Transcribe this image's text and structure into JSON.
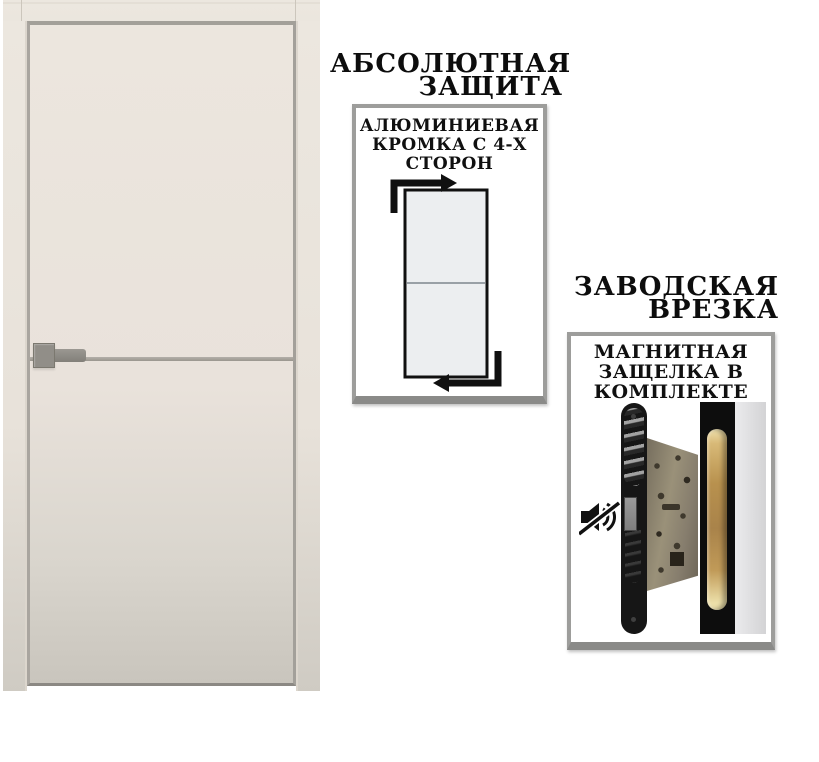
{
  "edge_feature": {
    "title_lines": [
      "АБСОЛЮТНАЯ",
      "ЗАЩИТА"
    ],
    "caption_lines": [
      "АЛЮМИНИЕВАЯ",
      "КРОМКА С 4-Х",
      "СТОРОН"
    ]
  },
  "latch_feature": {
    "title_lines": [
      "ЗАВОДСКАЯ",
      "ВРЕЗКА"
    ],
    "caption_lines": [
      "МАГНИТНАЯ",
      "ЗАЩЕЛКА В",
      "КОМПЛЕКТЕ"
    ]
  },
  "door": {
    "leaf_color_top": "#ece6de",
    "leaf_color_bottom": "#c9c5bd",
    "frame_color": "#ece7df",
    "aluminum_edge_color": "#a3a099",
    "molding_color": "#9a968e",
    "handle_color": "#918e88"
  },
  "panels": {
    "background": "#ffffff",
    "border_color": "#9d9d9b",
    "border_bottom_color": "#8a8a88",
    "text_color": "#0e0e0e"
  },
  "diagram": {
    "door_fill": "#eceef0",
    "outline_color": "#101010",
    "divider_color": "#99a0a6",
    "arrow_color": "#101010"
  },
  "lock_photo": {
    "faceplate_color": "#161616",
    "lock_body_color": "#8a8170",
    "strike_strip_color": "#0d0d0d",
    "brass_insert_color": "#b8914e",
    "door_edge_color": "#dedee0",
    "icons": [
      "mute-icon"
    ]
  }
}
